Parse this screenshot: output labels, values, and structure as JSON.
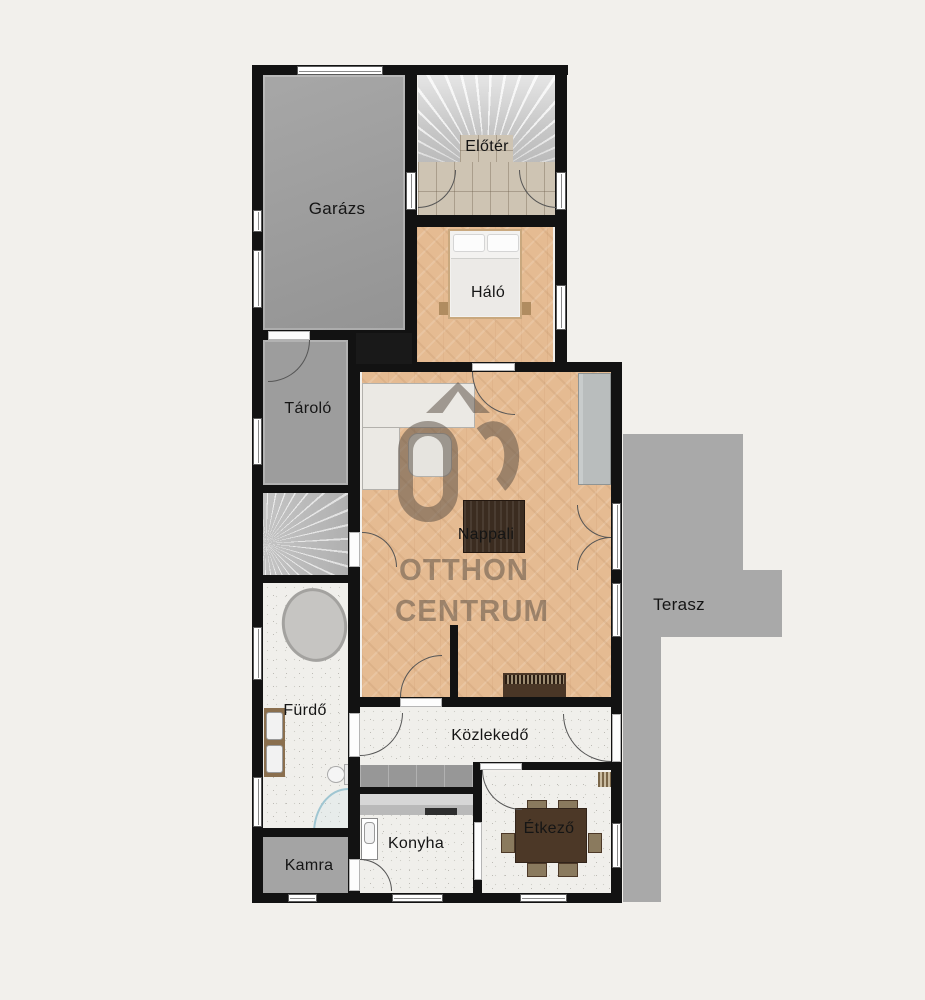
{
  "title": "Otthon Centrum lakás alaprajz",
  "rooms": [
    {
      "id": "garazs",
      "label": "Garázs"
    },
    {
      "id": "eloter",
      "label": "Előtér"
    },
    {
      "id": "halo",
      "label": "Háló"
    },
    {
      "id": "tarolo",
      "label": "Tároló"
    },
    {
      "id": "nappali",
      "label": "Nappali"
    },
    {
      "id": "terasz",
      "label": "Terasz"
    },
    {
      "id": "furdo",
      "label": "Fürdő"
    },
    {
      "id": "kozlekedo",
      "label": "Közlekedő"
    },
    {
      "id": "kamra",
      "label": "Kamra"
    },
    {
      "id": "konyha",
      "label": "Konyha"
    },
    {
      "id": "etkezo",
      "label": "Étkező"
    }
  ],
  "watermark": {
    "logo_text": "ÓC",
    "line1": "OTTHON",
    "line2": "CENTRUM"
  },
  "colors": {
    "background": "#f2f0ec",
    "wall": "#121212",
    "wood_floor": "#e5bb92",
    "gray_floor": "#9d9d9d",
    "terrace": "#a9a9a9",
    "tile_floor": "#f0efeb",
    "entry_tile": "#cec4b3",
    "watermark": "#5a4f45"
  }
}
